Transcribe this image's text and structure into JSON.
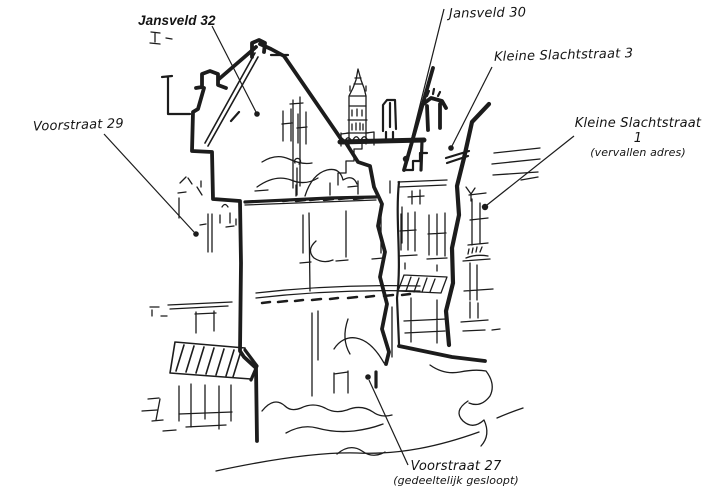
{
  "figure": {
    "background_color": "#ffffff",
    "ink_color": "#1c1c1c",
    "annotations": {
      "jansveld_32": {
        "text": "Jansveld 32"
      },
      "jansveld_30": {
        "text": "Jansveld 30"
      },
      "kleine_slachtstraat_3": {
        "text": "Kleine Slachtstraat 3"
      },
      "kleine_slachtstraat_1": {
        "text": "Kleine Slachtstraat 1",
        "subtext": "(vervallen adres)"
      },
      "voorstraat_29": {
        "text": "Voorstraat 29"
      },
      "voorstraat_27": {
        "text": "Voorstraat 27",
        "subtext": "(gedeeltelijk gesloopt)"
      }
    }
  }
}
